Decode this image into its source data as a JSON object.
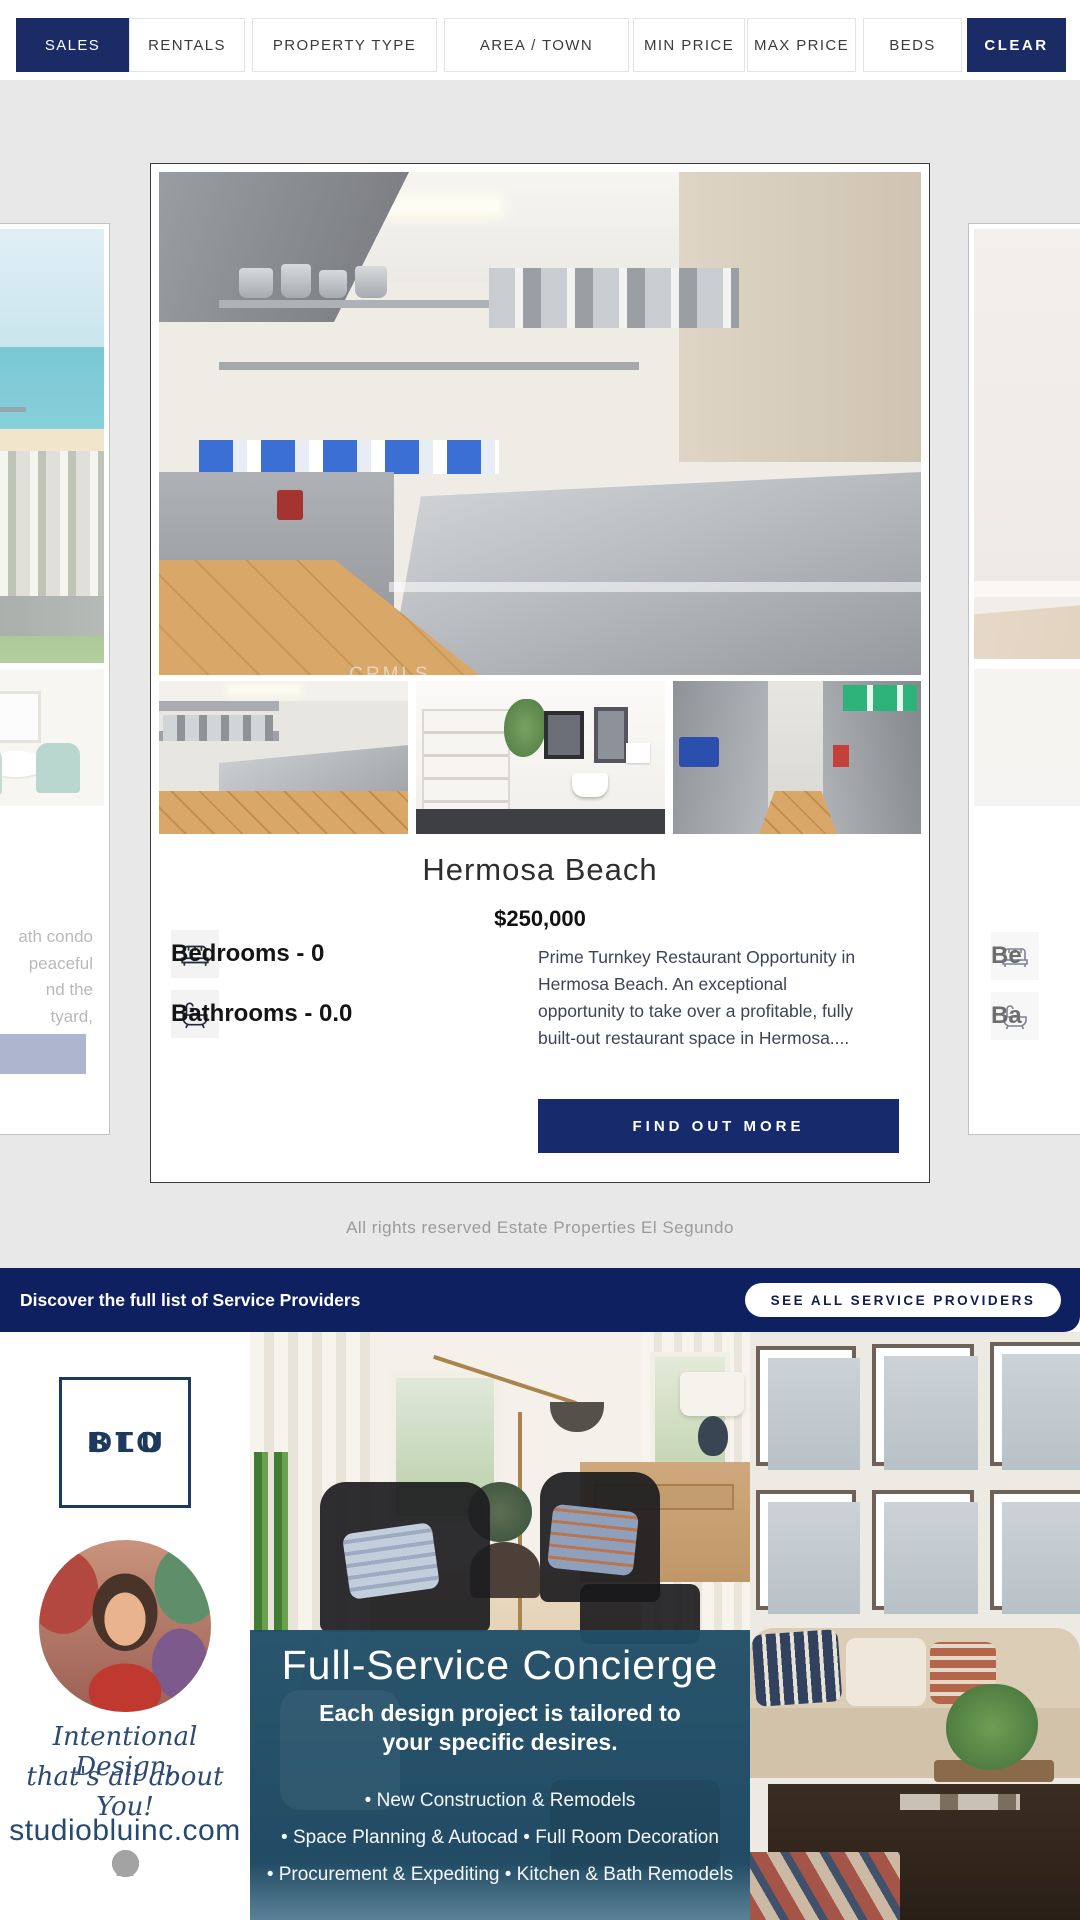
{
  "filter_bar": {
    "buttons": [
      {
        "label": "SALES",
        "active": true
      },
      {
        "label": "RENTALS",
        "active": false
      },
      {
        "label": "PROPERTY TYPE",
        "active": false
      },
      {
        "label": "AREA / TOWN",
        "active": false
      },
      {
        "label": "MIN PRICE",
        "active": false
      },
      {
        "label": "MAX PRICE",
        "active": false
      },
      {
        "label": "BEDS",
        "active": false
      },
      {
        "label": "CLEAR",
        "active": true
      }
    ]
  },
  "listing": {
    "town": "Hermosa Beach",
    "price": "$250,000",
    "bedrooms_label": "Bedrooms - 0",
    "bathrooms_label": "Bathrooms - 0.0",
    "description": "Prime Turnkey Restaurant Opportunity in Hermosa Beach. An exceptional opportunity to take over a profitable, fully built-out restaurant space in Hermosa....",
    "cta": "FIND OUT MORE",
    "watermark": "CRMLS"
  },
  "left_listing_preview": {
    "line1": "ath condo",
    "line2": "peaceful",
    "line3": "nd the",
    "line4": "tyard,"
  },
  "right_listing_preview": {
    "bedrooms_fragment": "Be",
    "bathrooms_fragment": "Ba"
  },
  "copyright": "All rights reserved Estate Properties El Segundo",
  "service_banner": {
    "message": "Discover the full list of Service Providers",
    "cta": "SEE ALL SERVICE PROVIDERS"
  },
  "advertisement": {
    "logo_row1": "S T U",
    "logo_row2": "D I O",
    "logo_row3": "B L U",
    "tagline_line1": "Intentional Design,",
    "tagline_line2": "that's all about You!",
    "website": "studiobluinc.com",
    "social": {
      "facebook_glyph": "f",
      "pinterest_glyph": "p",
      "linkedin_glyph": "in"
    },
    "overlay": {
      "title": "Full-Service Concierge",
      "subtitle_line1": "Each design project is tailored to",
      "subtitle_line2": "your specific desires.",
      "bullet1": "• New Construction & Remodels",
      "bullet2": "• Space Planning & Autocad • Full Room Decoration",
      "bullet3": "• Procurement & Expediting • Kitchen & Bath Remodels"
    }
  },
  "colors": {
    "filter_navy": "#1b2b66",
    "banner_navy": "#0f2060",
    "cta_navy": "#172a6b",
    "left_preview_button": "#7d89b3",
    "overlay_blue": "#214f69",
    "page_gray": "#e8e8e8"
  }
}
